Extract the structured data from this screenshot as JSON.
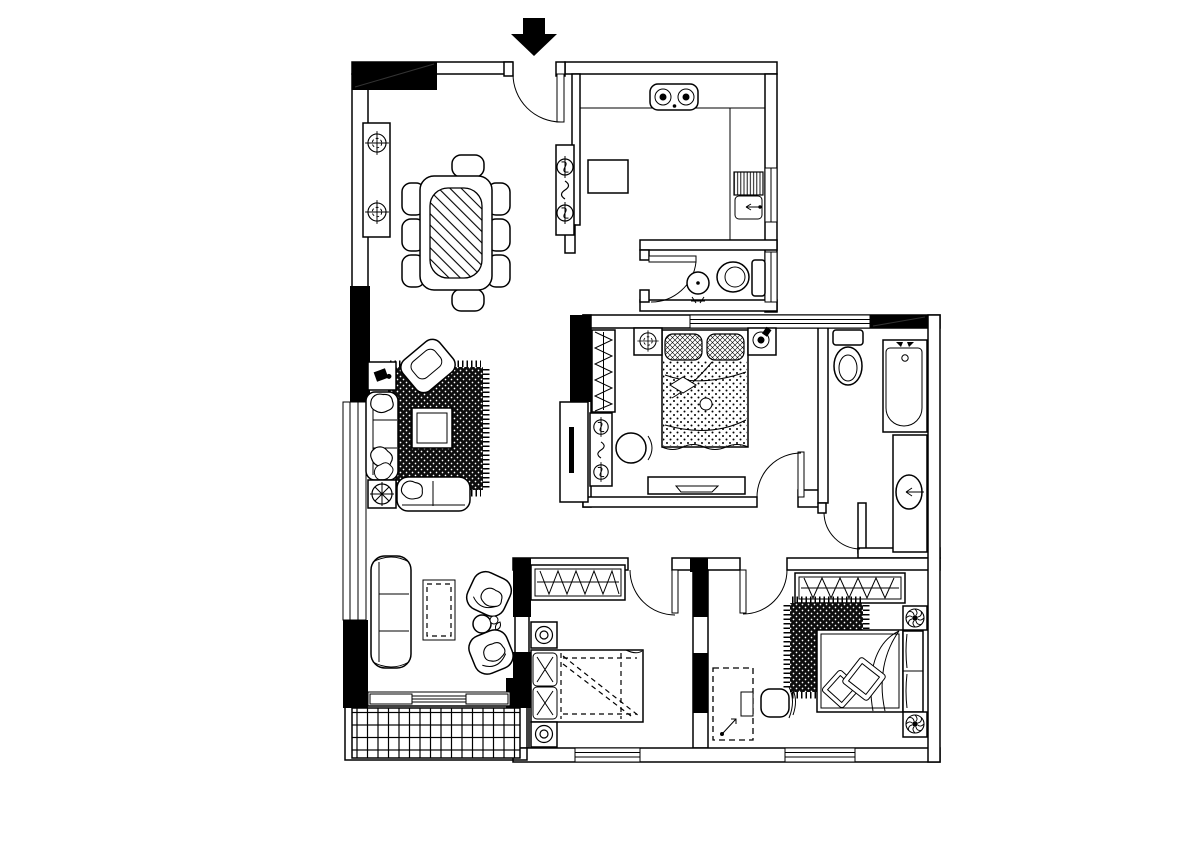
{
  "page": {
    "title": "Apartment Floor Plan",
    "background": "#ffffff",
    "ink": "#000000"
  },
  "plan": {
    "entry": {
      "marker": "entry-arrow",
      "direction": "down"
    },
    "rooms": [
      {
        "id": "dining-room",
        "fixtures": [
          "sideboard",
          "register-symbol-x2",
          "dining-table-glass",
          "dining-chair-x8"
        ]
      },
      {
        "id": "kitchen",
        "fixtures": [
          "l-counter",
          "cooktop-2-burner",
          "sink-with-drainboard",
          "refrigerator",
          "utility-cabinet",
          "valve-symbol-x2",
          "window"
        ]
      },
      {
        "id": "hall-bathroom",
        "fixtures": [
          "swing-door",
          "round-basin",
          "toilet",
          "window"
        ]
      },
      {
        "id": "living-room",
        "fixtures": [
          "area-rug-dark",
          "coffee-table",
          "armchair-rotated",
          "sofa-3-seat",
          "loveseat",
          "side-table-x2",
          "plant-symbol",
          "tv-cabinet"
        ]
      },
      {
        "id": "master-bedroom",
        "fixtures": [
          "wardrobe-hangers",
          "dresser",
          "stool",
          "double-bed",
          "pillow-x2",
          "nightstand-x2",
          "lamp-symbol",
          "tv-stand",
          "swing-door",
          "window"
        ]
      },
      {
        "id": "ensuite-bathroom",
        "fixtures": [
          "toilet",
          "bathtub",
          "vanity-basin",
          "swing-door",
          "window"
        ]
      },
      {
        "id": "sitting-area",
        "fixtures": [
          "curved-sofa",
          "rug-dashed",
          "lounge-chair-x2",
          "round-side-table",
          "sliding-door"
        ]
      },
      {
        "id": "balcony",
        "fixtures": [
          "tile-floor-grid"
        ]
      },
      {
        "id": "bedroom-2",
        "fixtures": [
          "wardrobe-hangers",
          "single-bed",
          "pillow-x2",
          "nightstand-lamp-x2",
          "swing-door",
          "window"
        ]
      },
      {
        "id": "bedroom-3",
        "fixtures": [
          "wardrobe-hangers",
          "area-rug-dark",
          "bed",
          "pillow-diamond-x2",
          "nightstand-fan-x2",
          "desk-dashed",
          "desk-chair",
          "swing-door",
          "window"
        ]
      }
    ]
  }
}
